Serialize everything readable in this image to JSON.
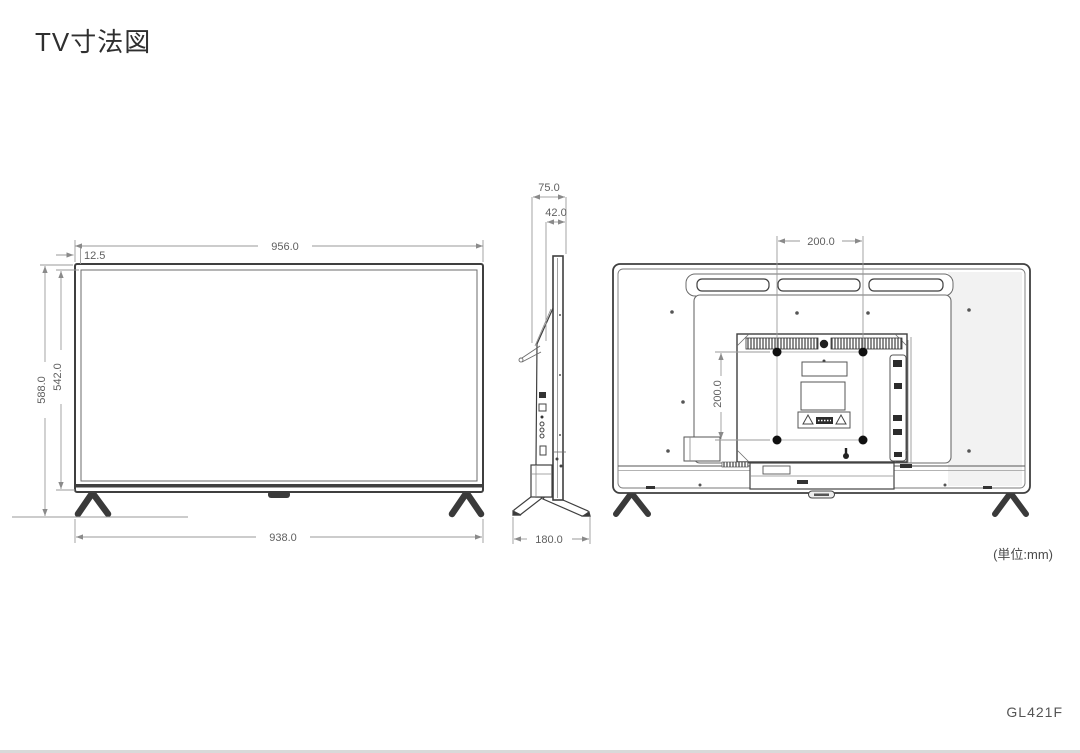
{
  "page": {
    "title": "TV寸法図",
    "unit_note": "(単位:mm)",
    "model": "GL421F"
  },
  "dimensions": {
    "front_width": "956.0",
    "front_bezel": "12.5",
    "front_height_total": "588.0",
    "front_height_panel": "542.0",
    "front_stand_width": "938.0",
    "side_depth_total": "75.0",
    "side_depth_panel": "42.0",
    "side_stand_depth": "180.0",
    "back_vesa_width": "200.0",
    "back_vesa_height": "200.0"
  },
  "colors": {
    "line": "#3f3f3f",
    "inner_line": "#777777",
    "dim_line": "#9a9a9a",
    "dim_text": "#5f5f5f",
    "fill_dark": "#2c2c2c",
    "background": "#ffffff"
  }
}
